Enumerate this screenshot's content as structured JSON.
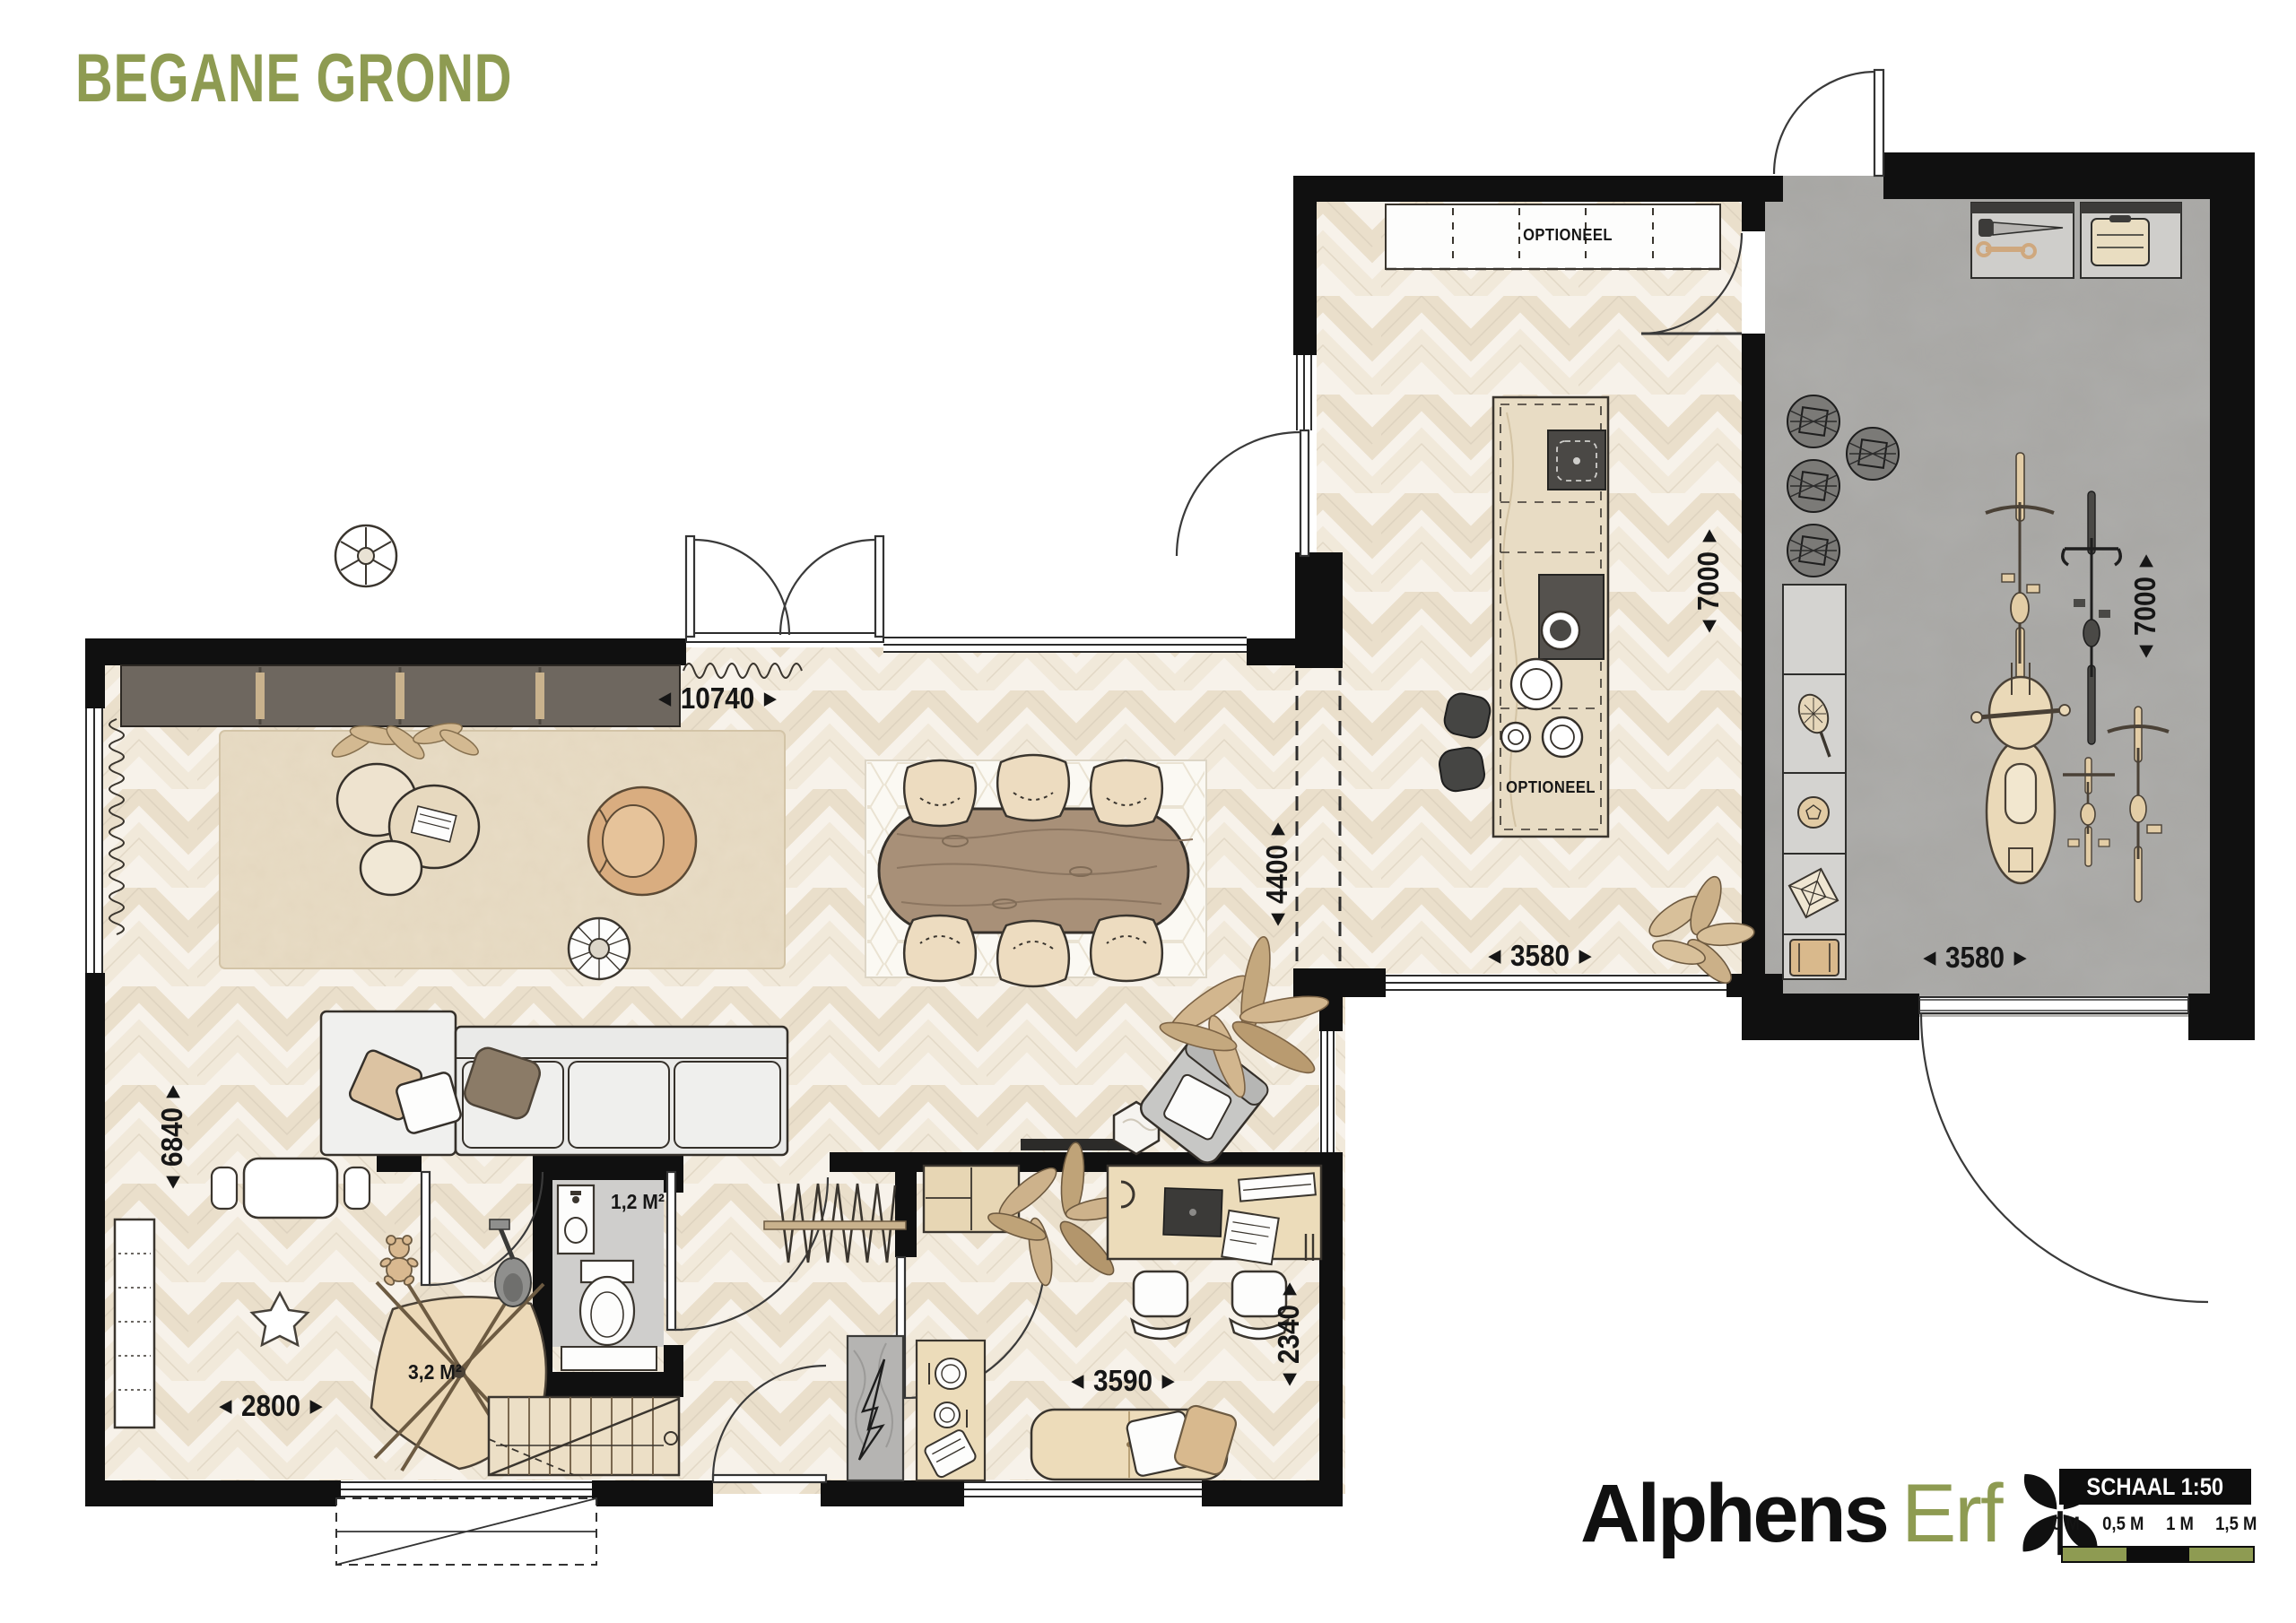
{
  "title": "BEGANE GROND",
  "logo": {
    "name_black": "Alphens",
    "name_olive": "Erf",
    "icon": "flower-icon"
  },
  "scale_bar": {
    "label": "SCHAAL 1:50",
    "ticks": [
      "0 M",
      "0,5 M",
      "1 M",
      "1,5 M"
    ],
    "segments": [
      "olive",
      "black",
      "olive"
    ]
  },
  "icons": {
    "arrow_left": "◀",
    "arrow_right": "▶"
  },
  "labels": {
    "optioneel_counter": "OPTIONEEL",
    "optioneel_island": "OPTIONEEL",
    "toilet_area": "1,2 M²",
    "stair_area": "3,2 M²"
  },
  "dimensions": {
    "living_width": "10740",
    "living_height": "6840",
    "play_width": "2800",
    "passage_height": "4400",
    "kitchen_width": "3580",
    "kitchen_height": "7000",
    "garage_width": "3580",
    "garage_height": "7000",
    "study_width": "3590",
    "study_height": "2340"
  },
  "colors": {
    "accent_olive": "#8e9b52",
    "wall_black": "#101010",
    "floor_cream": "#f6f1e9",
    "floor_garage_gray": "#a7a6a3",
    "wood_light": "#e8dcc4",
    "wood_table": "#a89078",
    "cabinet_dark": "#6e675f"
  },
  "rooms": [
    "woonkamer",
    "eetkamer",
    "speelhoek",
    "hal",
    "toilet",
    "trap",
    "werkplek",
    "keuken",
    "garage"
  ]
}
